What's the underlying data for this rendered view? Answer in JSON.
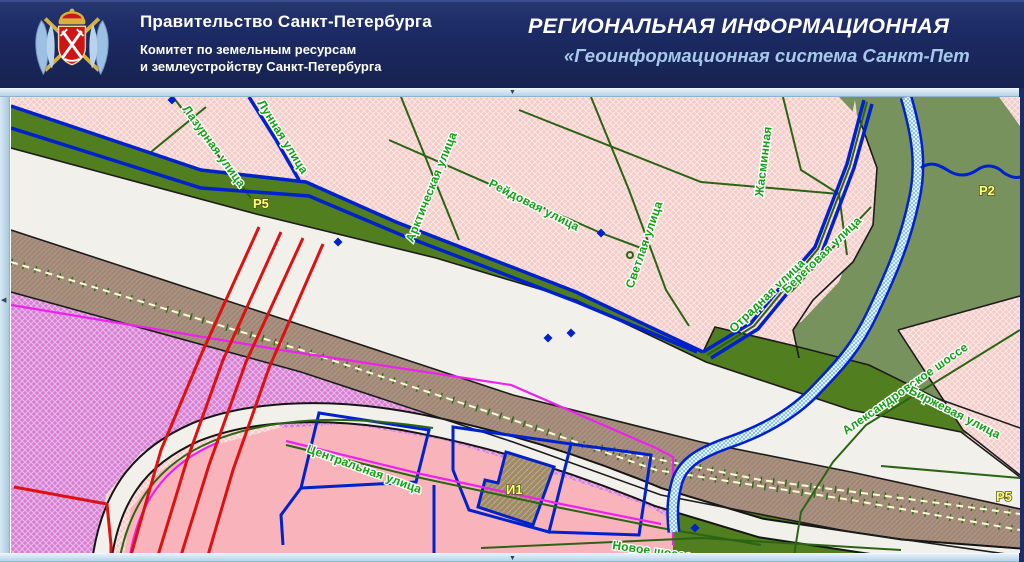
{
  "header": {
    "org_title": "Правительство Санкт-Петербурга",
    "org_subtitle_line1": "Комитет по земельным ресурсам",
    "org_subtitle_line2": "и землеустройству Санкт-Петербурга",
    "system_title": "РЕГИОНАЛЬНАЯ ИНФОРМАЦИОННАЯ",
    "system_subtitle": "«Геоинформационная система Санкт-Пет"
  },
  "icons": {
    "top_arrow": "▼",
    "bottom_arrow": "▼",
    "left_arrow": "◀"
  },
  "colors": {
    "header-bg": "#1d2b67",
    "header-title": "#ffffff",
    "header-subtitle": "#a6c8ea",
    "strip-bg": "#c9dfee",
    "pink-base": "#f5cbc7",
    "pink-solid": "#f9b4bb",
    "green-bright": "#517e1e",
    "green-muted": "#77925d",
    "white-band": "#f1f0ea",
    "brown-band": "#a9907f",
    "brown-parcel": "#a18b66",
    "magenta-zone": "#d77fd3",
    "road-blue": "#0022cc",
    "red-line": "#dd1111",
    "magenta-line": "#ee22ee",
    "street-green": "#2a6414",
    "label-green": "#13a013",
    "zone-label": "#ffff7a",
    "river-fill": "#9fd0ee",
    "track-light": "#fdfbd4"
  },
  "map": {
    "street_labels": [
      {
        "text": "Лазурная улица",
        "x": 181,
        "y": 109,
        "rot": 54
      },
      {
        "text": "Лунная улица",
        "x": 256,
        "y": 103,
        "rot": 58
      },
      {
        "text": "Арктическая улица",
        "x": 412,
        "y": 243,
        "rot": -68
      },
      {
        "text": "Рейдовая улица",
        "x": 487,
        "y": 186,
        "rot": 27
      },
      {
        "text": "Светлая улица",
        "x": 632,
        "y": 289,
        "rot": -71
      },
      {
        "text": "Жасминная",
        "x": 762,
        "y": 197,
        "rot": -83
      },
      {
        "text": "Отрадная улица",
        "x": 733,
        "y": 333,
        "rot": -44
      },
      {
        "text": "Береговая улица",
        "x": 786,
        "y": 294,
        "rot": -44
      },
      {
        "text": "Александровское шоссе",
        "x": 845,
        "y": 435,
        "rot": -35
      },
      {
        "text": "Биржевая улица",
        "x": 907,
        "y": 393,
        "rot": 27
      },
      {
        "text": "Центральная улица",
        "x": 305,
        "y": 452,
        "rot": 20
      },
      {
        "text": "Новое шоссе",
        "x": 611,
        "y": 549,
        "rot": 8
      }
    ],
    "zone_labels": [
      {
        "text": "Р5",
        "x": 252,
        "y": 208
      },
      {
        "text": "Р2",
        "x": 978,
        "y": 195
      },
      {
        "text": "И1",
        "x": 505,
        "y": 494
      },
      {
        "text": "Р5",
        "x": 995,
        "y": 501
      }
    ]
  }
}
